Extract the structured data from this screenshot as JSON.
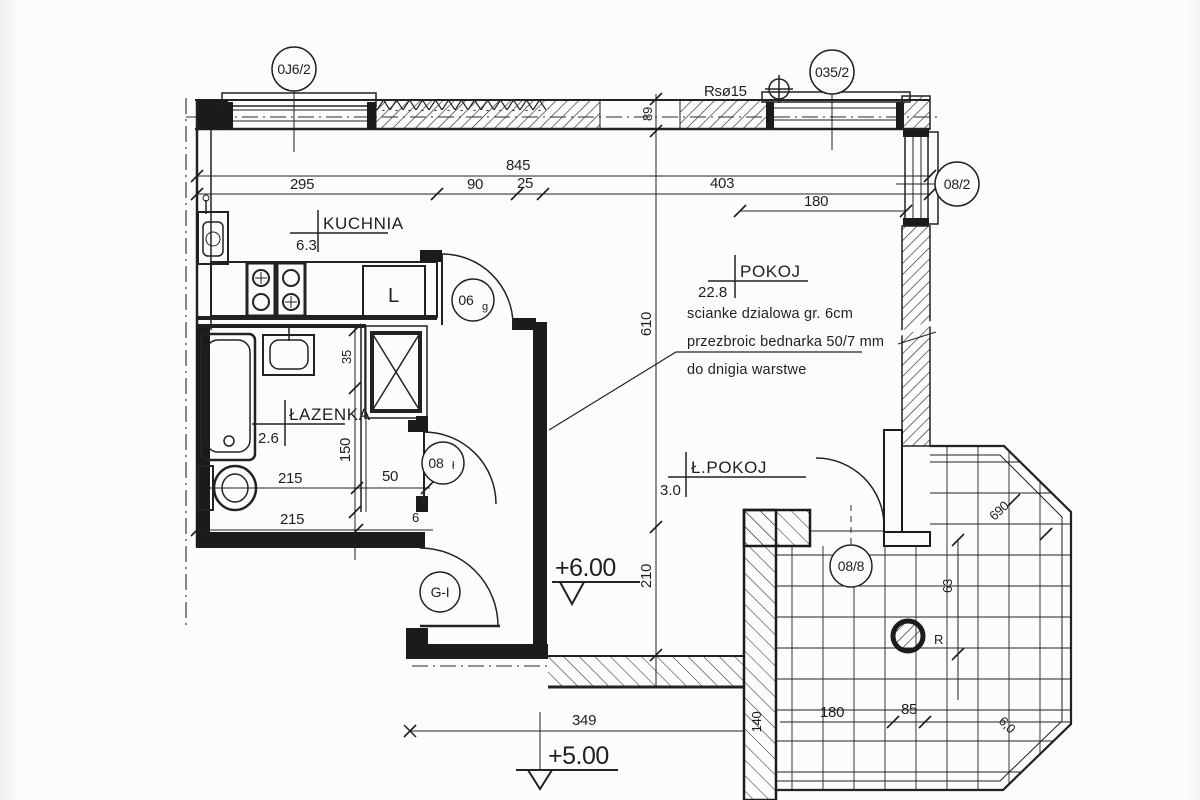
{
  "plan": {
    "window_tags": {
      "left": "0J6/2",
      "right": "035/2"
    },
    "door_tags": {
      "kitchen": "06",
      "kitchen_sub": "g",
      "bath": "08",
      "bath_sub": "ł",
      "entry": "G-I",
      "balcony": "08/8",
      "pokoj_window": "08/2"
    },
    "riser_label": "Rsø15",
    "rooms": [
      {
        "name": "KUCHNIA",
        "area": "6.3"
      },
      {
        "name": "POKOJ",
        "area": "22.8"
      },
      {
        "name": "ŁAZENKA",
        "area": "2.6"
      },
      {
        "name": "Ł.POKOJ",
        "area": "3.0"
      }
    ],
    "fridge_label": "L",
    "note_lines": [
      "scianke dzialowa gr. 6cm",
      "przezbroic bednarka 50/7 mm",
      "do dnigia warstwe"
    ],
    "levels": {
      "upper": "+6.00",
      "lower": "+5.00"
    },
    "dims": {
      "total_width": "845",
      "kitchen_width": "295",
      "hall_width": "90",
      "partition": "25",
      "pokoj_width": "403",
      "pokoj_window_width": "180",
      "wall_89": "89",
      "pokoj_height": "610",
      "hall_height": "210",
      "bath_35": "35",
      "bath_150": "150",
      "shaft_50": "50",
      "bath_215_a": "215",
      "bath_215_b": "215",
      "small_6": "6",
      "bottom_349": "349",
      "balcony_180": "180",
      "balcony_85": "85",
      "balcony_690": "690",
      "balcony_63": "63",
      "balcony_140": "140",
      "balcony_60": "6,0",
      "balcony_r": "R"
    }
  }
}
